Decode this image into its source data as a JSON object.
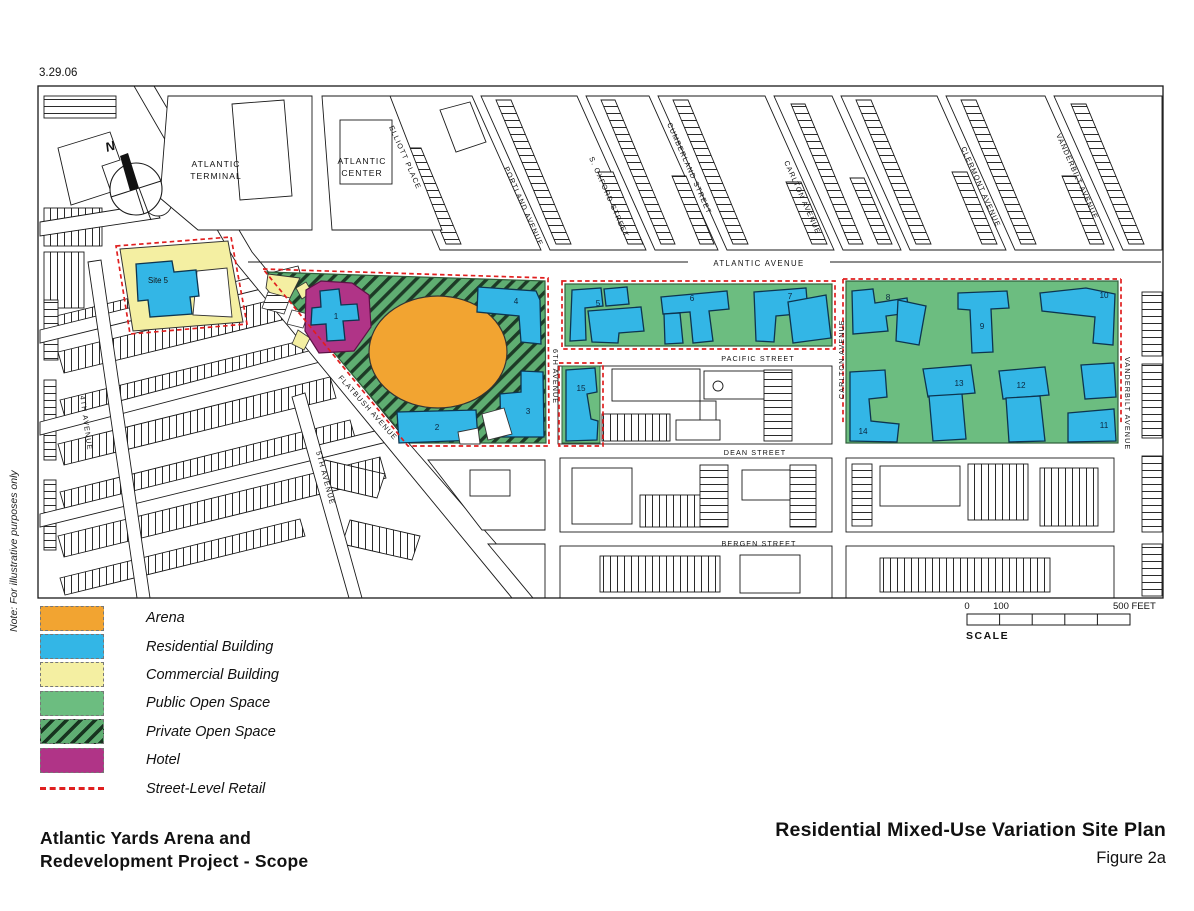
{
  "date_stamp": "3.29.06",
  "note": "Note: For illustrative purposes only",
  "compass": {
    "north_label": "N"
  },
  "places": {
    "atlantic_terminal": [
      "ATLANTIC",
      "TERMINAL"
    ],
    "atlantic_center": [
      "ATLANTIC",
      "CENTER"
    ],
    "site_5": "Site 5"
  },
  "streets": {
    "atlantic_avenue": "ATLANTIC AVENUE",
    "pacific_street": "PACIFIC STREET",
    "dean_street": "DEAN STREET",
    "bergen_street": "BERGEN STREET",
    "flatbush_avenue": "FLATBUSH AVENUE",
    "fourth_avenue": "4TH AVENUE",
    "fifth_avenue": "5TH AVENUE",
    "sixth_avenue": "6TH AVENUE",
    "carlton_avenue": "CARLTON AVENUE",
    "carlton_avenue_north": "CARLTON AVENUE",
    "vanderbilt_avenue": "VANDERBILT AVENUE",
    "vanderbilt_avenue_north": "VANDERBILT AVENUE",
    "clermont_avenue": "CLERMONT AVENUE",
    "cumberland_street": "CUMBERLAND STREET",
    "s_oxford_street": "S. OXFORD STREET",
    "portland_avenue": "PORTLAND AVENUE",
    "elliott_place": "ELLIOTT PLACE"
  },
  "buildings": {
    "b1": "1",
    "b2": "2",
    "b3": "3",
    "b4": "4",
    "b5": "5",
    "b6": "6",
    "b7": "7",
    "b8": "8",
    "b9": "9",
    "b10": "10",
    "b11": "11",
    "b12": "12",
    "b13": "13",
    "b14": "14",
    "b15": "15"
  },
  "legend": {
    "items": [
      {
        "key": "arena",
        "label": "Arena"
      },
      {
        "key": "residential",
        "label": "Residential Building"
      },
      {
        "key": "commercial",
        "label": "Commercial Building"
      },
      {
        "key": "public",
        "label": "Public Open Space"
      },
      {
        "key": "private",
        "label": "Private Open Space"
      },
      {
        "key": "hotel",
        "label": "Hotel"
      },
      {
        "key": "retail",
        "label": "Street-Level Retail"
      }
    ]
  },
  "scale": {
    "tick_start": "0",
    "tick_100": "100",
    "tick_end": "500 FEET",
    "label": "SCALE"
  },
  "footer": {
    "project_title_line1": "Atlantic Yards Arena and",
    "project_title_line2": "Redevelopment Project - Scope",
    "figure_title": "Residential Mixed-Use Variation Site Plan",
    "figure_number": "Figure 2a"
  },
  "colors": {
    "arena": "#F2A431",
    "residential": "#33B6E6",
    "commercial": "#F4EFA2",
    "public_open_space": "#6CBD80",
    "private_open_space_base": "#5FAE72",
    "hotel": "#B03487",
    "street_level_retail": "#E01F1F",
    "map_line": "#1A1A1A"
  }
}
